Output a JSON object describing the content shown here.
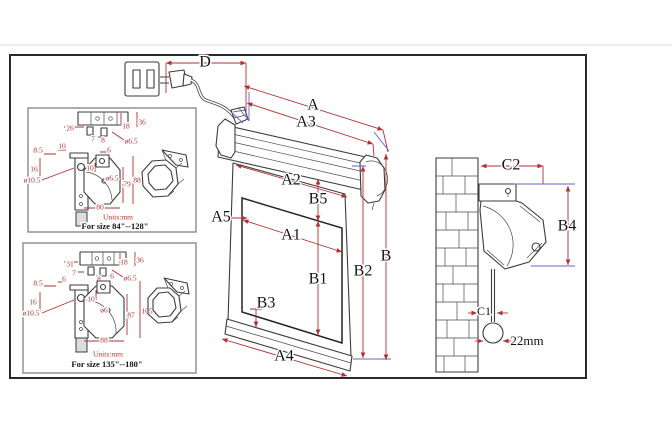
{
  "drawing": {
    "main_labels": {
      "d": "D",
      "a": "A",
      "a3": "A3",
      "a2": "A2",
      "b5": "B5",
      "a5": "A5",
      "a1": "A1",
      "b1": "B1",
      "b2": "B2",
      "b": "B",
      "b3": "B3",
      "a4": "A4",
      "c2": "C2",
      "b4": "B4",
      "c1": "C1",
      "weight_dia": "22mm"
    },
    "detail_top": {
      "units": "Units:mm",
      "size_range": "For size 84\"--128\"",
      "dims": {
        "rail_w": "26",
        "rail_e": "18",
        "rail_h": "36",
        "off7": "7",
        "off8": "8",
        "hole": "ø6.5",
        "side_t": "8.5",
        "side_w": "10",
        "side_m": "16",
        "side_hole": "ø10.5",
        "tab": "6",
        "tab_off": "10",
        "plate_hole": "ø6.5",
        "inner_h": "79",
        "outer_h": "88",
        "width": "80"
      }
    },
    "detail_bottom": {
      "units": "Units:mm",
      "size_range": "For size 135\"--180\"",
      "dims": {
        "rail_w": "31",
        "rail_e": "18",
        "rail_h": "36",
        "off7": "7",
        "off8": "8",
        "off6": "6",
        "hole": "ø6.5",
        "side_t": "8.5",
        "side_w": "6",
        "side_m": "16",
        "side_hole": "ø10.5",
        "tab_off": "10",
        "plate_hole": "ø6",
        "inner_h": "87",
        "outer_h": "105",
        "width": "88"
      }
    }
  }
}
